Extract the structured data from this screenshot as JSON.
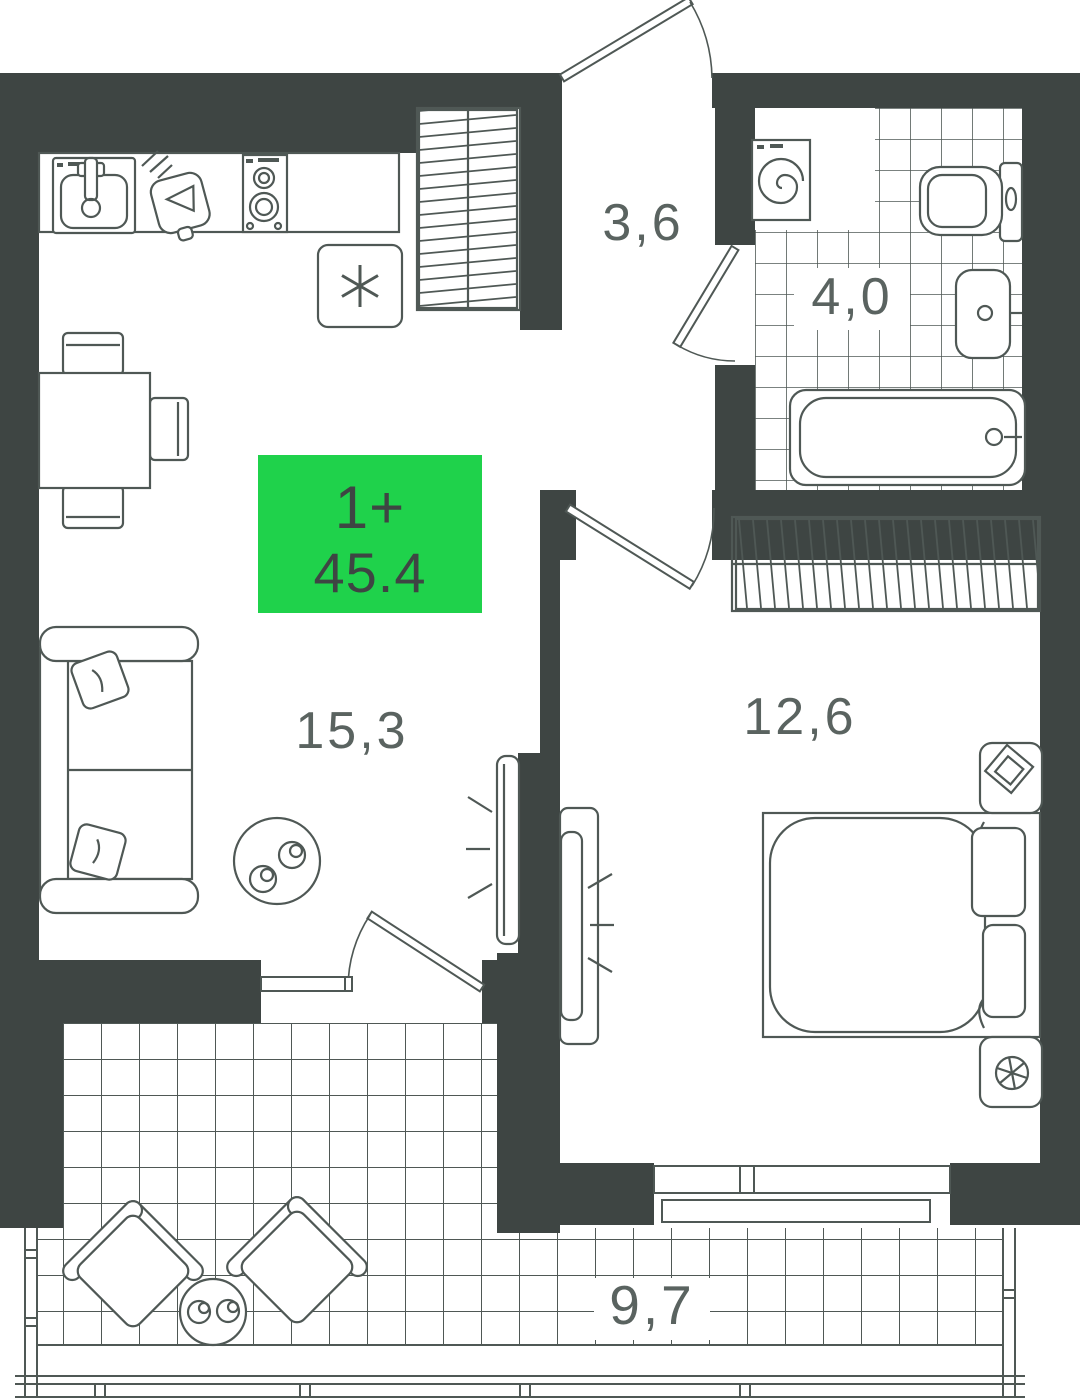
{
  "plan": {
    "badge": {
      "type_label": "1+",
      "area_label": "45.4",
      "bg_color": "#1FD24B",
      "text_color": "#3E4543"
    },
    "rooms": {
      "hallway": {
        "area_label": "3,6"
      },
      "bathroom": {
        "area_label": "4,0"
      },
      "living_kitchen": {
        "area_label": "15,3"
      },
      "bedroom": {
        "area_label": "12,6"
      },
      "balcony": {
        "area_label": "9,7"
      }
    },
    "colors": {
      "wall": "#3E4543",
      "line": "#4F5855",
      "label": "#5A6360",
      "background": "#FFFFFF",
      "badge_green": "#1FD24B"
    },
    "icons": [
      "kitchen-sink-icon",
      "cutting-board-icon",
      "stove-icon",
      "fridge-snowflake-icon",
      "closet-hatch-icon",
      "washing-machine-icon",
      "toilet-icon",
      "washbasin-icon",
      "bathtub-icon",
      "dining-table-icon",
      "chair-icon",
      "sofa-icon",
      "coffee-table-icon",
      "tv-icon",
      "wardrobe-hatch-icon",
      "bed-icon",
      "nightstand-lamp-icon",
      "nightstand-fan-icon",
      "armchair-icon",
      "balcony-table-icon",
      "door-swing-icon",
      "window-icon",
      "balcony-railing-icon"
    ]
  }
}
